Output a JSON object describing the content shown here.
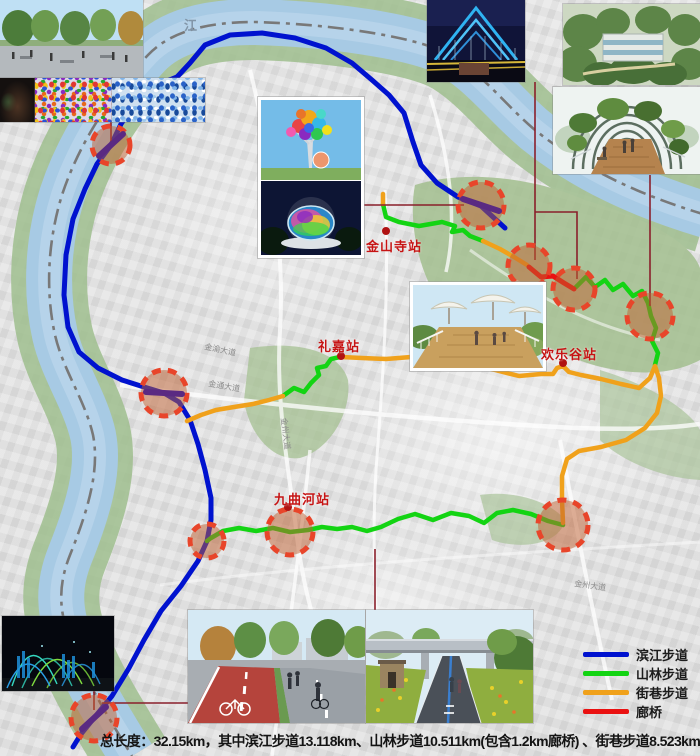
{
  "caption": "总长度：32.15km，其中滨江步道13.118km、山林步道10.511km(包含1.2km廊桥) 、街巷步道8.523km",
  "legend": {
    "items": [
      {
        "label": "滨江步道",
        "color": "#0012cf"
      },
      {
        "label": "山林步道",
        "color": "#13d413"
      },
      {
        "label": "街巷步道",
        "color": "#f0a11b"
      },
      {
        "label": "廊桥",
        "color": "#ea1111"
      }
    ]
  },
  "stations": [
    {
      "name": "金山寺站"
    },
    {
      "name": "礼嘉站"
    },
    {
      "name": "欢乐谷站"
    },
    {
      "name": "九曲河站"
    }
  ],
  "map_labels": {
    "river": "江",
    "roads": [
      {
        "text": "金渝大道"
      },
      {
        "text": "金通大道"
      },
      {
        "text": "金州大道"
      },
      {
        "text": "金州大道"
      }
    ]
  },
  "colors": {
    "river": "#a7cae4",
    "park": "#a3bf8f",
    "station_ring": "#e8452a",
    "connector": "#8a1f2b",
    "bridge_bar": "#5a2a82"
  }
}
